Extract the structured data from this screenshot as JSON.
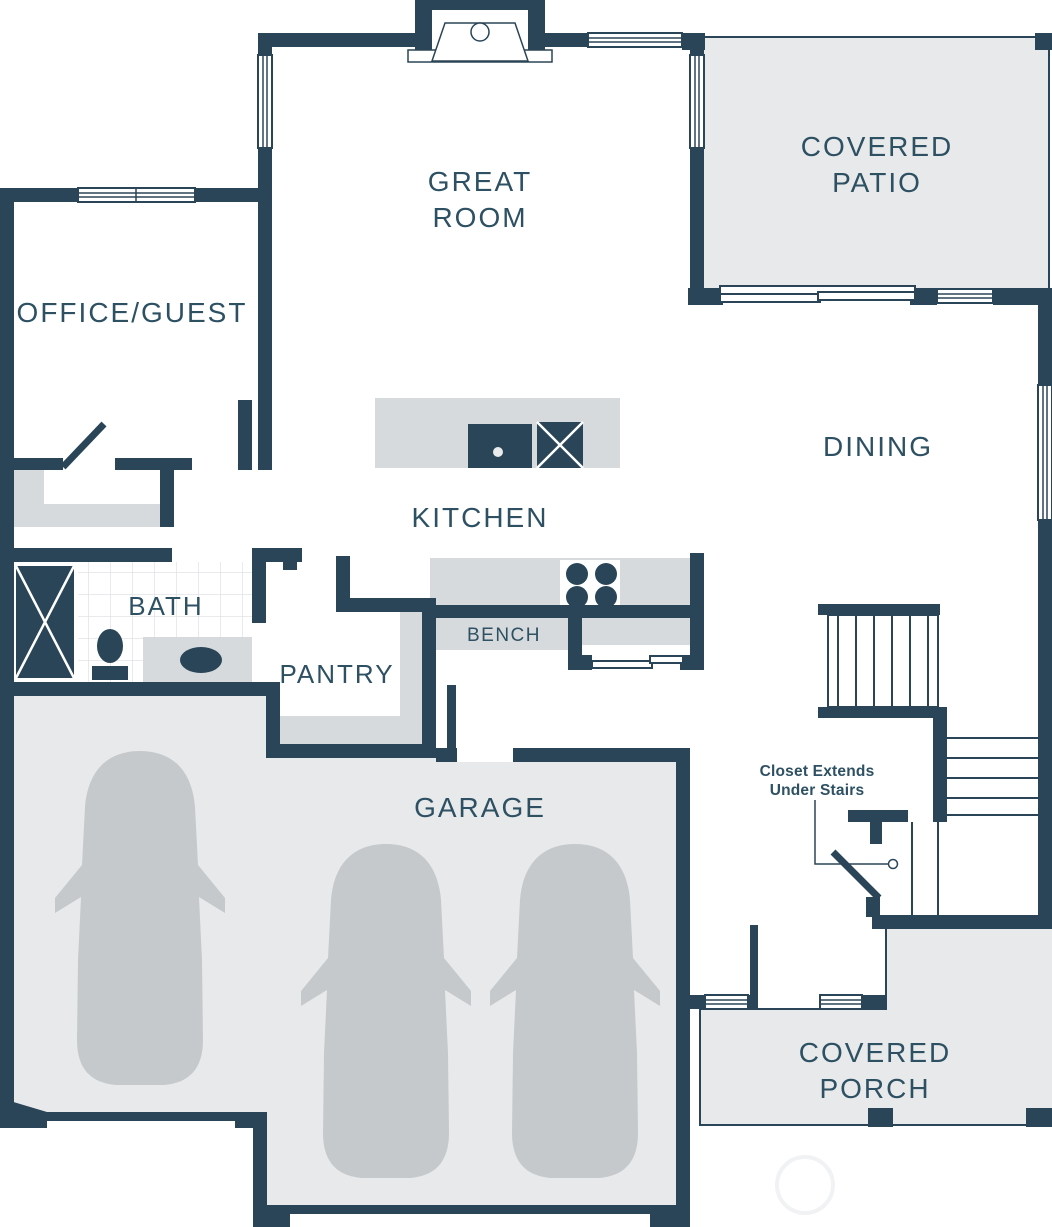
{
  "theme": {
    "wall": "#2a4557",
    "floor": "#e7e9ea",
    "furn": "#d7dadc",
    "car": "#c6c9cc",
    "label": "#2d5063",
    "tile": "#e0e3e5",
    "watermark": "#f1f2f3",
    "bg": "#ffffff"
  },
  "rooms": {
    "great_room": {
      "line1": "GREAT",
      "line2": "ROOM"
    },
    "covered_patio": {
      "line1": "COVERED",
      "line2": "PATIO"
    },
    "office_guest": {
      "label": "OFFICE/GUEST"
    },
    "dining": {
      "label": "DINING"
    },
    "kitchen": {
      "label": "KITCHEN"
    },
    "bath": {
      "label": "BATH"
    },
    "pantry": {
      "label": "PANTRY"
    },
    "bench": {
      "label": "BENCH"
    },
    "garage": {
      "label": "GARAGE"
    },
    "covered_porch": {
      "line1": "COVERED",
      "line2": "PORCH"
    }
  },
  "annotations": {
    "closet_note_line1": "Closet Extends",
    "closet_note_line2": "Under Stairs"
  }
}
